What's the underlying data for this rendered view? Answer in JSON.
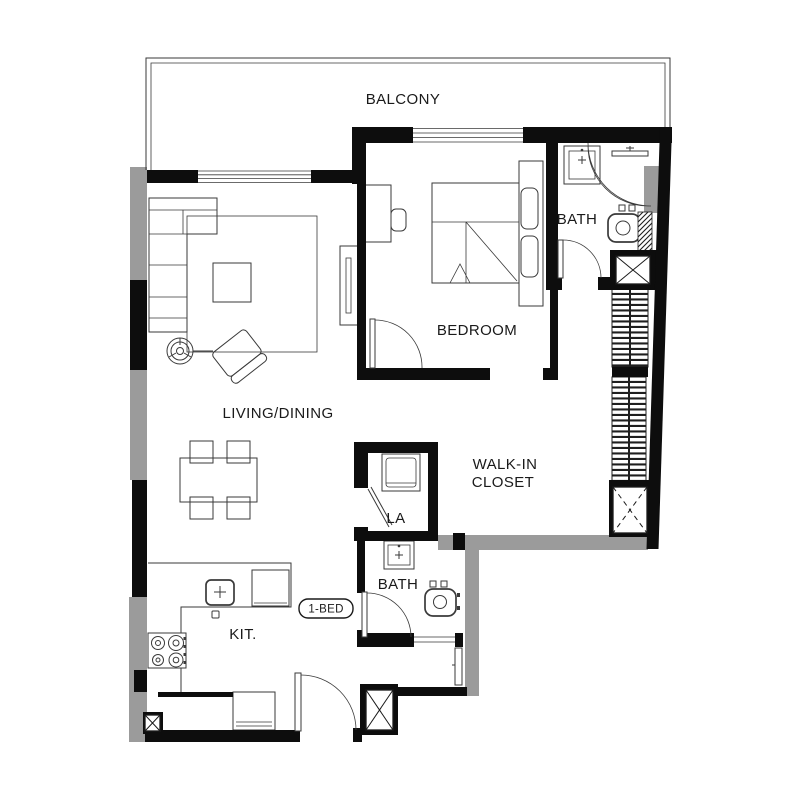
{
  "drawing_title": "1-BED unit floor plan",
  "colors": {
    "wall": "#0d0d0d",
    "gray_wall": "#9b9b9b",
    "line": "#3a3a3a",
    "background": "#ffffff",
    "label": "#1a1a1a"
  },
  "rooms": {
    "balcony": {
      "label": "BALCONY"
    },
    "bedroom": {
      "label": "BEDROOM"
    },
    "bath_top": {
      "label": "BATH"
    },
    "living_dining": {
      "label": "LIVING/DINING"
    },
    "walk_in_closet": {
      "label_line1": "WALK-IN",
      "label_line2": "CLOSET"
    },
    "laundry": {
      "label": "LA"
    },
    "bath_bottom": {
      "label": "BATH"
    },
    "kitchen": {
      "label": "KIT."
    }
  },
  "badge": {
    "label": "1-BED"
  }
}
